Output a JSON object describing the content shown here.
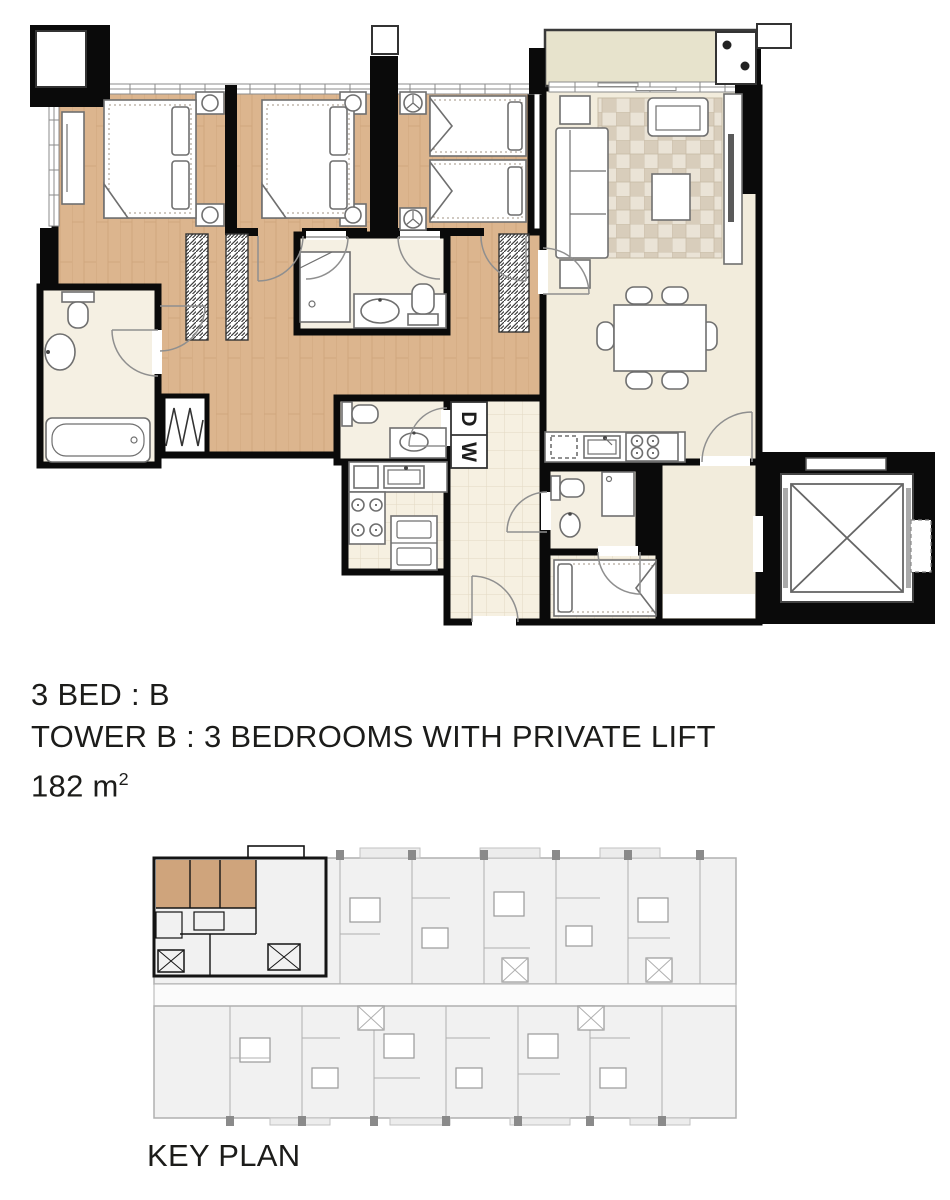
{
  "unit_info": {
    "line1": "3 BED : B",
    "line2": "TOWER B : 3 BEDROOMS WITH PRIVATE LIFT",
    "area_value": "182 m",
    "area_exponent": "2"
  },
  "key_plan": {
    "label": "KEY PLAN"
  },
  "floor_plan": {
    "labels": {
      "washer": "W",
      "dryer": "D"
    }
  },
  "colors": {
    "wall": "#0a0a0a",
    "wood_floor": "#dcb58e",
    "wood_line": "#c09467",
    "living_floor": "#f2ecdc",
    "balcony_floor": "#e7e3cc",
    "tile_floor": "#f6f0e1",
    "tile_line": "#e3d9c2",
    "bath_floor": "#f5f0e3",
    "fixture": "#6f6f6f",
    "rug_a": "#eae3d6",
    "rug_b": "#d8cdbb",
    "rug_line": "#c6b9a4",
    "key_fill": "#f1f1f1",
    "key_line": "#b0b0b0",
    "key_dark": "#8a8a8a",
    "hl_wood": "#cfa47c",
    "hl_cream": "#efe8d3",
    "text_color": "#1c1c1a"
  }
}
